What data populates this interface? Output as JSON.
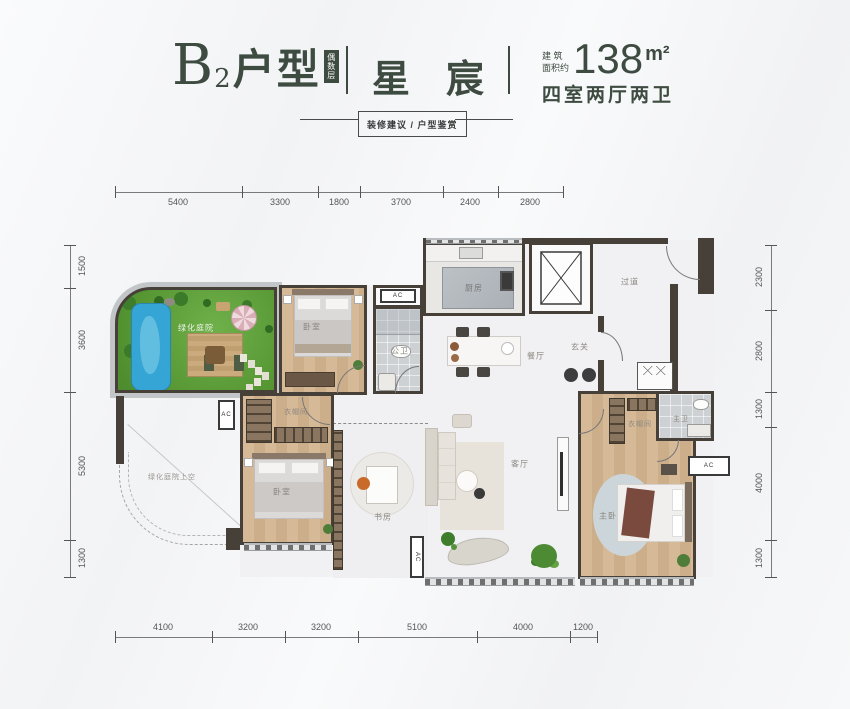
{
  "header": {
    "unit_letter": "B",
    "unit_number": "2",
    "unit_word": "户型",
    "badge": "偶数层",
    "project_name": "星宸",
    "area_label_line1": "建 筑",
    "area_label_line2": "面积约",
    "area_value": "138",
    "area_unit": "m²",
    "layout_summary": "四室两厅两卫",
    "banner": "装修建议 / 户型鉴赏"
  },
  "dimensions": {
    "top": [
      "5400",
      "3300",
      "1800",
      "3700",
      "2400",
      "2800"
    ],
    "bottom": [
      "4100",
      "3200",
      "3200",
      "5100",
      "4000",
      "1200"
    ],
    "left": [
      "1500",
      "3600",
      "5300",
      "1300"
    ],
    "right": [
      "2300",
      "2800",
      "1300",
      "4000",
      "1300"
    ]
  },
  "rooms": {
    "garden": "绿化庭院",
    "bedroom_top": "卧室",
    "public_bath": "公卫",
    "kitchen": "厨房",
    "hallway": "过道",
    "dining": "餐厅",
    "foyer": "玄关",
    "bedroom_left": "卧室",
    "closet_left": "衣帽间",
    "study": "书房",
    "living": "客厅",
    "master_bedroom": "主卧",
    "master_closet": "衣帽间",
    "master_bath": "主卫",
    "open_air": "绿化庭院上空",
    "ac": "AC"
  },
  "colors": {
    "accent": "#3e4b41",
    "wall": "#474039",
    "garden_green": "#5fa33a",
    "pool_blue": "#35a5d6",
    "wood": "#cfb292",
    "dim_text": "#565656"
  }
}
